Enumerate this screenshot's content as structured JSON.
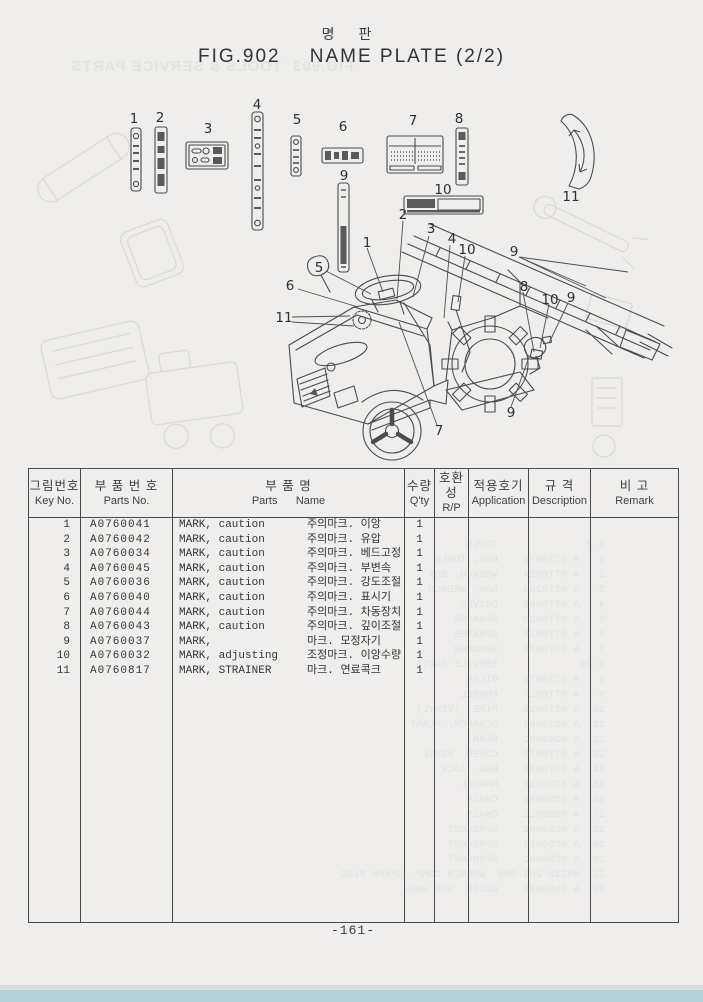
{
  "colors": {
    "paper": "#efeeec",
    "ink": "#3f3f3f",
    "line": "#4a4a4a",
    "footer": "#b6d3d8",
    "ghost": "#9aa0a6"
  },
  "header": {
    "title_kr": "명  판",
    "title": "FIG.902    NAME PLATE (2/2)"
  },
  "ghost": {
    "title": "FIG.903  TOOLS & SERVICE PARTS",
    "rows": [
      "1-7              TOOLS",
      "1   A 0770071    BAG, TOOLS",
      "2   A 0770024    WRENCH, BOX",
      "3   A 0770264    BAR, WRENCH",
      "4   A 0770009    DRIVER",
      "5   A 0770023    SPANNER",
      "6   A 0770026    SPANNER",
      "7   A 0770028    SPANNER",
      "8-20             SERVICE PARTS",
      "8   A 0770076    OILER",
      "9   A 0770017    FUNNEL",
      "10  A 0770018    PIPE, (VINYL)",
      "11  A 0830001    SCRAPER, PLANT",
      "12  A 0340032    REAR",
      "13  A 0770070    COVER, VINYL",
      "14  A 0770031    BAG, JACK",
      "15  A 0770217    MANUAL",
      "16  A 0550036    CHAIN",
      "17  A 0550011    CHAIN",
      "18  A 0550002    SPROCKET",
      "19  A 0550011    SPROCKET",
      "20  A 0550062    SPROCKET",
      "21  80218-281-000  WRENCH COMP, SPARK PLUG",
      "22  A 0550038    GUIDE, SUB HOSE"
    ]
  },
  "illustration": {
    "callouts": [
      {
        "label": "1",
        "x": 134,
        "y": 119
      },
      {
        "label": "2",
        "x": 160,
        "y": 118
      },
      {
        "label": "3",
        "x": 208,
        "y": 129
      },
      {
        "label": "4",
        "x": 257,
        "y": 105
      },
      {
        "label": "5",
        "x": 297,
        "y": 120
      },
      {
        "label": "6",
        "x": 343,
        "y": 127
      },
      {
        "label": "7",
        "x": 413,
        "y": 121
      },
      {
        "label": "8",
        "x": 459,
        "y": 119
      },
      {
        "label": "9",
        "x": 344,
        "y": 176
      },
      {
        "label": "10",
        "x": 443,
        "y": 190
      },
      {
        "label": "11",
        "x": 571,
        "y": 197
      },
      {
        "label": "2",
        "x": 403,
        "y": 215
      },
      {
        "label": "1",
        "x": 367,
        "y": 243
      },
      {
        "label": "3",
        "x": 431,
        "y": 229
      },
      {
        "label": "4",
        "x": 452,
        "y": 239
      },
      {
        "label": "10",
        "x": 467,
        "y": 250
      },
      {
        "label": "9",
        "x": 514,
        "y": 252
      },
      {
        "label": "5",
        "x": 319,
        "y": 268
      },
      {
        "label": "6",
        "x": 290,
        "y": 286
      },
      {
        "label": "11",
        "x": 284,
        "y": 318
      },
      {
        "label": "8",
        "x": 524,
        "y": 287
      },
      {
        "label": "10",
        "x": 550,
        "y": 300
      },
      {
        "label": "9",
        "x": 571,
        "y": 298
      },
      {
        "label": "7",
        "x": 439,
        "y": 431
      },
      {
        "label": "9",
        "x": 511,
        "y": 413
      }
    ]
  },
  "table": {
    "headers": [
      {
        "kr": "그림번호",
        "en": "Key No."
      },
      {
        "kr": "부 품 번 호",
        "en": "Parts No."
      },
      {
        "kr": "부        품        명",
        "en": "Parts      Name"
      },
      {
        "kr": "수량",
        "en": "Q'ty"
      },
      {
        "kr": "호환성",
        "en": "R/P"
      },
      {
        "kr": "적용호기",
        "en": "Application"
      },
      {
        "kr": "규  격",
        "en": "Description"
      },
      {
        "kr": "비    고",
        "en": "Remark"
      }
    ],
    "rows": [
      {
        "key": "1",
        "part_no": "A0760041",
        "name_en": "MARK, caution",
        "name_kr": "주의마크. 이앙",
        "qty": "1",
        "rp": "",
        "application": "",
        "description": "",
        "remark": ""
      },
      {
        "key": "2",
        "part_no": "A0760042",
        "name_en": "MARK, caution",
        "name_kr": "주의마크. 유압",
        "qty": "1",
        "rp": "",
        "application": "",
        "description": "",
        "remark": ""
      },
      {
        "key": "3",
        "part_no": "A0760034",
        "name_en": "MARK, caution",
        "name_kr": "주의마크. 베드고정",
        "qty": "1",
        "rp": "",
        "application": "",
        "description": "",
        "remark": ""
      },
      {
        "key": "4",
        "part_no": "A0760045",
        "name_en": "MARK, caution",
        "name_kr": "주의마크. 부변속",
        "qty": "1",
        "rp": "",
        "application": "",
        "description": "",
        "remark": ""
      },
      {
        "key": "5",
        "part_no": "A0760036",
        "name_en": "MARK, caution",
        "name_kr": "주의마크. 강도조절",
        "qty": "1",
        "rp": "",
        "application": "",
        "description": "",
        "remark": ""
      },
      {
        "key": "6",
        "part_no": "A0760040",
        "name_en": "MARK, caution",
        "name_kr": "주의마크. 표시기",
        "qty": "1",
        "rp": "",
        "application": "",
        "description": "",
        "remark": ""
      },
      {
        "key": "7",
        "part_no": "A0760044",
        "name_en": "MARK, caution",
        "name_kr": "주의마크. 차동장치",
        "qty": "1",
        "rp": "",
        "application": "",
        "description": "",
        "remark": ""
      },
      {
        "key": "8",
        "part_no": "A0760043",
        "name_en": "MARK, caution",
        "name_kr": "주의마크. 깊이조절",
        "qty": "1",
        "rp": "",
        "application": "",
        "description": "",
        "remark": ""
      },
      {
        "key": "9",
        "part_no": "A0760037",
        "name_en": "MARK,",
        "name_kr": "마크. 모정자기",
        "qty": "1",
        "rp": "",
        "application": "",
        "description": "",
        "remark": ""
      },
      {
        "key": "10",
        "part_no": "A0760032",
        "name_en": "MARK, adjusting",
        "name_kr": "조정마크. 이앙수량",
        "qty": "1",
        "rp": "",
        "application": "",
        "description": "",
        "remark": ""
      },
      {
        "key": "11",
        "part_no": "A0760817",
        "name_en": "MARK, STRAINER",
        "name_kr": "마크. 연료콕크",
        "qty": "1",
        "rp": "",
        "application": "",
        "description": "",
        "remark": ""
      }
    ]
  },
  "footer": {
    "page_number": "-161-"
  }
}
